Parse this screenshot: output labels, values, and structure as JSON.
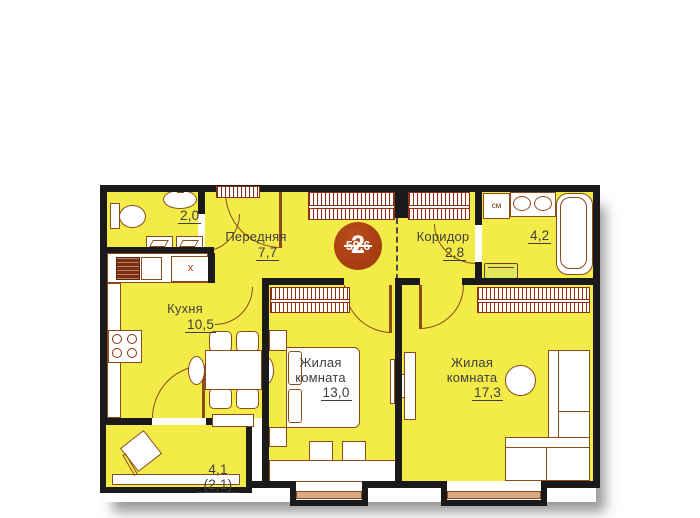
{
  "apartment": {
    "badge": {
      "rooms_count": "2",
      "total_area": "59,6"
    },
    "rooms": {
      "wc": {
        "area": "2,0"
      },
      "hallway": {
        "name": "Передняя",
        "area": "7,7"
      },
      "corridor": {
        "name": "Коридор",
        "area": "2,8"
      },
      "bathroom": {
        "area": "4,2"
      },
      "kitchen": {
        "name": "Кухня",
        "area": "10,5"
      },
      "living_room_1": {
        "name": "Жилая комната",
        "area": "13,0"
      },
      "living_room_2": {
        "name": "Жилая комната",
        "area": "17,3"
      },
      "balcony": {
        "area": "4,1 (2,1)"
      }
    },
    "annotations": {
      "washing_machine": "см",
      "kitchen_unit": "x"
    },
    "colors": {
      "room_fill": "#f3ec48",
      "wall": "#1a1a1a",
      "furniture_outline": "#8d4a1a",
      "hatch": "#8d2f10",
      "badge_bg": "#a63c10",
      "label_text": "#3f3f3f"
    }
  }
}
